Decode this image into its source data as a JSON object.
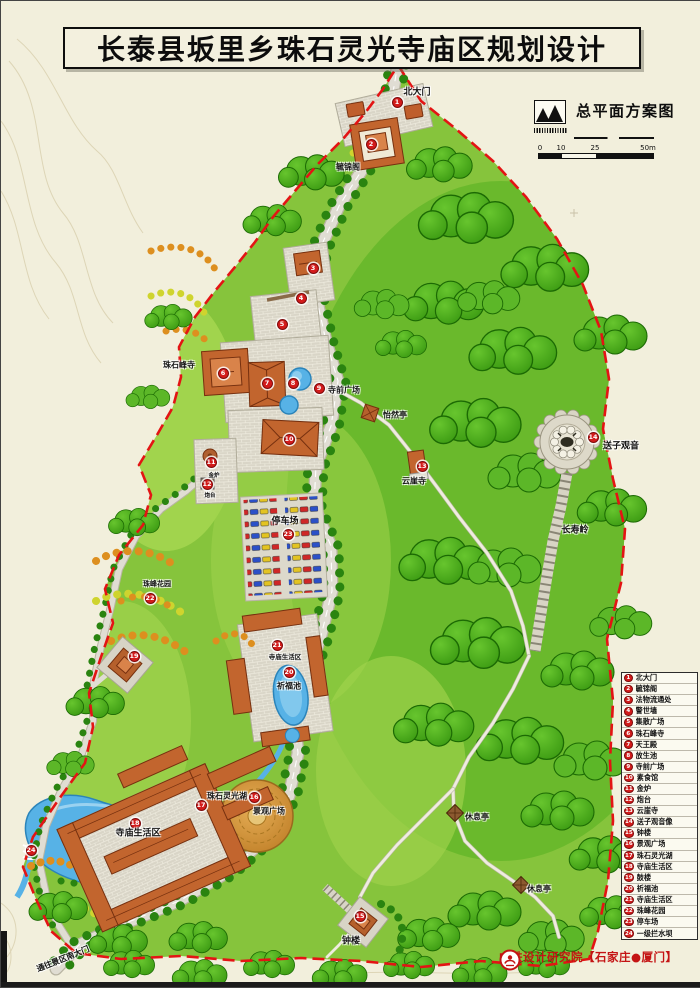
{
  "page": {
    "title": "长泰县坂里乡珠石灵光寺庙区规划设计"
  },
  "header": {
    "plan_label": "总平面方案图",
    "logo_icon": "mountain-logo"
  },
  "scale_bar": {
    "ticks": [
      "0",
      "10",
      "25",
      "50m"
    ]
  },
  "legend": {
    "items": [
      {
        "num": "1",
        "label": "北大门"
      },
      {
        "num": "2",
        "label": "毓锦阁"
      },
      {
        "num": "3",
        "label": "法物流通处"
      },
      {
        "num": "4",
        "label": "警世墙"
      },
      {
        "num": "5",
        "label": "集散广场"
      },
      {
        "num": "6",
        "label": "珠石峰寺"
      },
      {
        "num": "7",
        "label": "天王殿"
      },
      {
        "num": "8",
        "label": "放生池"
      },
      {
        "num": "9",
        "label": "寺前广场"
      },
      {
        "num": "10",
        "label": "素食馆"
      },
      {
        "num": "11",
        "label": "金炉"
      },
      {
        "num": "12",
        "label": "炮台"
      },
      {
        "num": "13",
        "label": "云崖寺"
      },
      {
        "num": "14",
        "label": "送子观音像"
      },
      {
        "num": "15",
        "label": "钟楼"
      },
      {
        "num": "16",
        "label": "景观广场"
      },
      {
        "num": "17",
        "label": "珠石灵光湖"
      },
      {
        "num": "18",
        "label": "寺庙生活区"
      },
      {
        "num": "19",
        "label": "鼓楼"
      },
      {
        "num": "20",
        "label": "祈福池"
      },
      {
        "num": "21",
        "label": "寺庙生活区"
      },
      {
        "num": "22",
        "label": "珠峰花园"
      },
      {
        "num": "23",
        "label": "停车场"
      },
      {
        "num": "24",
        "label": "一级拦水坝"
      }
    ]
  },
  "footer": {
    "credit": "中铁设计研究院【石家庄●厦门】"
  },
  "colors": {
    "boundary_red": "#e31414",
    "marker_red": "#d31b1b",
    "canopy_green": "#3f9e14",
    "lawn_green": "#86c43c",
    "water_blue": "#57b2e6",
    "roof_orange": "#c2652e",
    "credit_red": "#c41414"
  },
  "map": {
    "markers": [
      {
        "n": "1",
        "x": 396,
        "y": 101
      },
      {
        "n": "2",
        "x": 370,
        "y": 143
      },
      {
        "n": "3",
        "x": 312,
        "y": 267
      },
      {
        "n": "4",
        "x": 300,
        "y": 297
      },
      {
        "n": "5",
        "x": 281,
        "y": 323
      },
      {
        "n": "6",
        "x": 222,
        "y": 372
      },
      {
        "n": "7",
        "x": 266,
        "y": 382
      },
      {
        "n": "8",
        "x": 292,
        "y": 382
      },
      {
        "n": "9",
        "x": 318,
        "y": 387
      },
      {
        "n": "10",
        "x": 288,
        "y": 438
      },
      {
        "n": "11",
        "x": 210,
        "y": 461
      },
      {
        "n": "12",
        "x": 206,
        "y": 483
      },
      {
        "n": "13",
        "x": 421,
        "y": 465
      },
      {
        "n": "14",
        "x": 592,
        "y": 436
      },
      {
        "n": "15",
        "x": 359,
        "y": 915
      },
      {
        "n": "16",
        "x": 253,
        "y": 796
      },
      {
        "n": "17",
        "x": 200,
        "y": 804
      },
      {
        "n": "18",
        "x": 134,
        "y": 822
      },
      {
        "n": "19",
        "x": 133,
        "y": 655
      },
      {
        "n": "20",
        "x": 288,
        "y": 671
      },
      {
        "n": "21",
        "x": 276,
        "y": 644
      },
      {
        "n": "22",
        "x": 149,
        "y": 597
      },
      {
        "n": "23",
        "x": 287,
        "y": 533
      },
      {
        "n": "24",
        "x": 30,
        "y": 849
      }
    ],
    "labels": [
      {
        "t": "北大门",
        "x": 416,
        "y": 90,
        "s": 9
      },
      {
        "t": "毓锦阁",
        "x": 347,
        "y": 166,
        "s": 8
      },
      {
        "t": "珠石峰寺",
        "x": 178,
        "y": 364,
        "s": 8
      },
      {
        "t": "寺前广场",
        "x": 343,
        "y": 389,
        "s": 8
      },
      {
        "t": "怡然亭",
        "x": 394,
        "y": 414,
        "s": 8
      },
      {
        "t": "云崖寺",
        "x": 413,
        "y": 480,
        "s": 8
      },
      {
        "t": "送子观音",
        "x": 620,
        "y": 444,
        "s": 9
      },
      {
        "t": "长寿岭",
        "x": 574,
        "y": 528,
        "s": 9
      },
      {
        "t": "停车场",
        "x": 284,
        "y": 519,
        "s": 9
      },
      {
        "t": "珠峰花园",
        "x": 156,
        "y": 583,
        "s": 7
      },
      {
        "t": "寺庙生活区",
        "x": 284,
        "y": 655,
        "s": 6.5
      },
      {
        "t": "祈福池",
        "x": 288,
        "y": 685,
        "s": 8
      },
      {
        "t": "珠石灵光湖",
        "x": 226,
        "y": 795,
        "s": 8
      },
      {
        "t": "景观广场",
        "x": 268,
        "y": 810,
        "s": 8
      },
      {
        "t": "寺庙生活区",
        "x": 137,
        "y": 831,
        "s": 9
      },
      {
        "t": "休息亭",
        "x": 476,
        "y": 816,
        "s": 8
      },
      {
        "t": "休息亭",
        "x": 538,
        "y": 888,
        "s": 8
      },
      {
        "t": "钟楼",
        "x": 350,
        "y": 939,
        "s": 9
      },
      {
        "t": "金炉",
        "x": 213,
        "y": 474,
        "s": 5.5
      },
      {
        "t": "炮台",
        "x": 209,
        "y": 494,
        "s": 5.5
      },
      {
        "t": "通往景区南大门",
        "x": 62,
        "y": 958,
        "s": 8,
        "r": -22
      }
    ]
  }
}
